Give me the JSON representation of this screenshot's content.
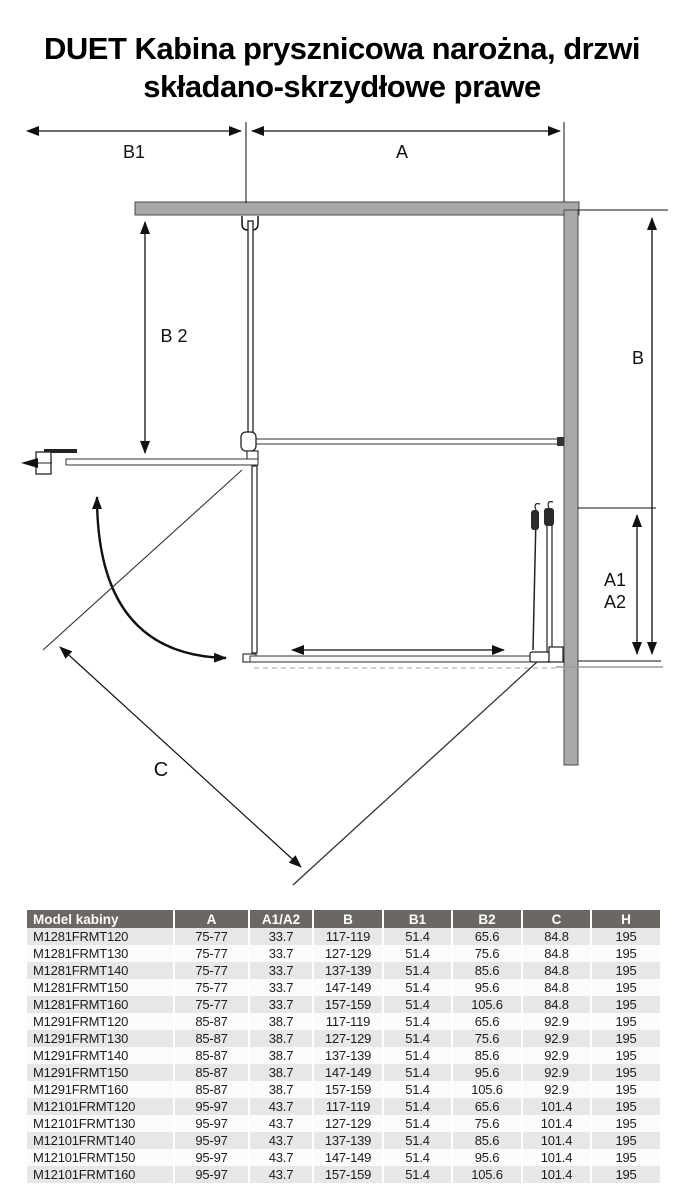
{
  "title": {
    "line1": "DUET Kabina prysznicowa narożna, drzwi",
    "line2": "składano-skrzydłowe prawe"
  },
  "diagram": {
    "labels": {
      "b1": "B1",
      "a": "A",
      "b2": "B 2",
      "b": "B",
      "a1": "A1",
      "a2": "A2",
      "c": "C"
    }
  },
  "table": {
    "headers": [
      "Model kabiny",
      "A",
      "A1/A2",
      "B",
      "B1",
      "B2",
      "C",
      "H"
    ],
    "rows": [
      [
        "M1281FRMT120",
        "75-77",
        "33.7",
        "117-119",
        "51.4",
        "65.6",
        "84.8",
        "195"
      ],
      [
        "M1281FRMT130",
        "75-77",
        "33.7",
        "127-129",
        "51.4",
        "75.6",
        "84.8",
        "195"
      ],
      [
        "M1281FRMT140",
        "75-77",
        "33.7",
        "137-139",
        "51.4",
        "85.6",
        "84.8",
        "195"
      ],
      [
        "M1281FRMT150",
        "75-77",
        "33.7",
        "147-149",
        "51.4",
        "95.6",
        "84.8",
        "195"
      ],
      [
        "M1281FRMT160",
        "75-77",
        "33.7",
        "157-159",
        "51.4",
        "105.6",
        "84.8",
        "195"
      ],
      [
        "M1291FRMT120",
        "85-87",
        "38.7",
        "117-119",
        "51.4",
        "65.6",
        "92.9",
        "195"
      ],
      [
        "M1291FRMT130",
        "85-87",
        "38.7",
        "127-129",
        "51.4",
        "75.6",
        "92.9",
        "195"
      ],
      [
        "M1291FRMT140",
        "85-87",
        "38.7",
        "137-139",
        "51.4",
        "85.6",
        "92.9",
        "195"
      ],
      [
        "M1291FRMT150",
        "85-87",
        "38.7",
        "147-149",
        "51.4",
        "95.6",
        "92.9",
        "195"
      ],
      [
        "M1291FRMT160",
        "85-87",
        "38.7",
        "157-159",
        "51.4",
        "105.6",
        "92.9",
        "195"
      ],
      [
        "M12101FRMT120",
        "95-97",
        "43.7",
        "117-119",
        "51.4",
        "65.6",
        "101.4",
        "195"
      ],
      [
        "M12101FRMT130",
        "95-97",
        "43.7",
        "127-129",
        "51.4",
        "75.6",
        "101.4",
        "195"
      ],
      [
        "M12101FRMT140",
        "95-97",
        "43.7",
        "137-139",
        "51.4",
        "85.6",
        "101.4",
        "195"
      ],
      [
        "M12101FRMT150",
        "95-97",
        "43.7",
        "147-149",
        "51.4",
        "95.6",
        "101.4",
        "195"
      ],
      [
        "M12101FRMT160",
        "95-97",
        "43.7",
        "157-159",
        "51.4",
        "105.6",
        "101.4",
        "195"
      ]
    ]
  },
  "colors": {
    "header_bg": "#6b6762",
    "row_alt": "#e7e7e7",
    "row_base": "#fbfbfb",
    "wall_fill": "#a8a8a8",
    "line": "#111111"
  }
}
